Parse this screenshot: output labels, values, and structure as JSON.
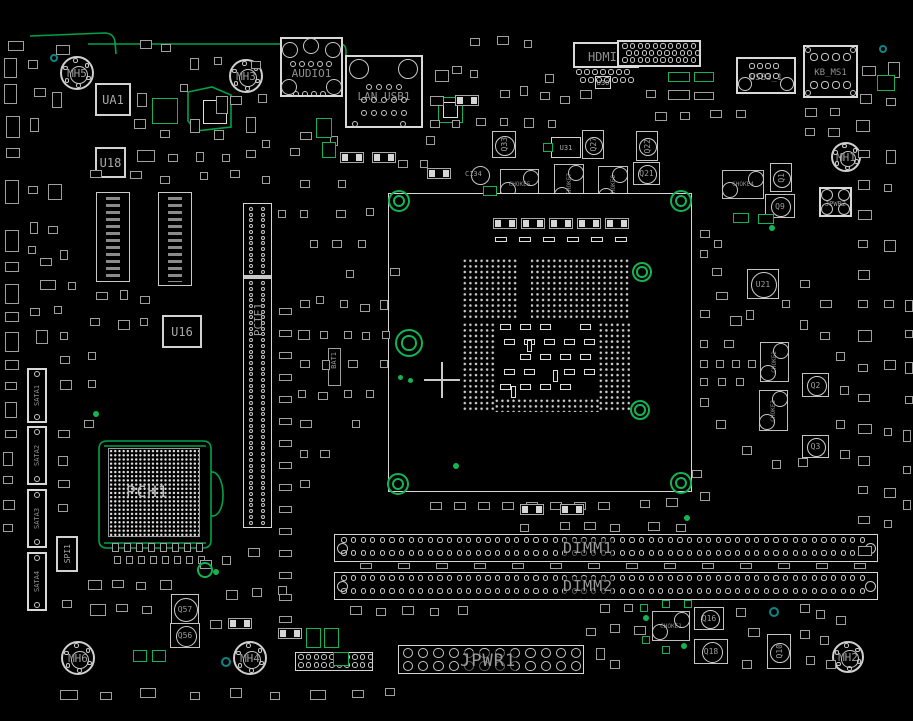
{
  "colors": {
    "background": "#000000",
    "outline": "#c8c8c8",
    "silkscreen": "#9a9a9a",
    "trace_green": "#00a248",
    "highlight_green": "#12b551",
    "teal": "#0d8585"
  },
  "board": {
    "width": 913,
    "height": 721
  },
  "components": [
    {
      "id": "ua1",
      "label": "UA1",
      "type": "ic",
      "x": 95,
      "y": 83,
      "w": 36,
      "h": 33
    },
    {
      "id": "u18",
      "label": "U18",
      "type": "ic",
      "x": 95,
      "y": 147,
      "w": 31,
      "h": 31
    },
    {
      "id": "u16",
      "label": "U16",
      "type": "ic",
      "x": 162,
      "y": 315,
      "w": 40,
      "h": 33
    },
    {
      "id": "u30",
      "label": "U30",
      "type": "ic_s",
      "x": 595,
      "y": 76,
      "w": 16,
      "h": 13
    },
    {
      "id": "u31",
      "label": "U31",
      "type": "ic_s",
      "x": 551,
      "y": 137,
      "w": 30,
      "h": 21
    },
    {
      "id": "spi1",
      "label": "SPI1",
      "type": "ic_v",
      "x": 56,
      "y": 536,
      "w": 22,
      "h": 36
    },
    {
      "id": "u21",
      "label": "U21",
      "type": "qcirc",
      "x": 747,
      "y": 269,
      "w": 32,
      "h": 30
    },
    {
      "id": "q33",
      "label": "Q33",
      "type": "qcirc_v",
      "x": 492,
      "y": 131,
      "w": 24,
      "h": 27
    },
    {
      "id": "q27",
      "label": "Q27",
      "type": "qcirc_v",
      "x": 582,
      "y": 130,
      "w": 22,
      "h": 29
    },
    {
      "id": "q22",
      "label": "Q22",
      "type": "qcirc_v",
      "x": 636,
      "y": 131,
      "w": 22,
      "h": 30
    },
    {
      "id": "q21",
      "label": "Q21",
      "type": "qcirc",
      "x": 633,
      "y": 162,
      "w": 27,
      "h": 23
    },
    {
      "id": "q1",
      "label": "Q1",
      "type": "qcirc_v",
      "x": 770,
      "y": 163,
      "w": 22,
      "h": 29
    },
    {
      "id": "q9",
      "label": "Q9",
      "type": "qcirc",
      "x": 765,
      "y": 194,
      "w": 30,
      "h": 24
    },
    {
      "id": "q2",
      "label": "Q2",
      "type": "qcirc",
      "x": 802,
      "y": 373,
      "w": 27,
      "h": 24
    },
    {
      "id": "q3",
      "label": "Q3",
      "type": "qcirc",
      "x": 802,
      "y": 435,
      "w": 27,
      "h": 23
    },
    {
      "id": "q10",
      "label": "Q10",
      "type": "qcirc_v",
      "x": 767,
      "y": 634,
      "w": 24,
      "h": 35
    },
    {
      "id": "q16",
      "label": "Q16",
      "type": "qcirc",
      "x": 694,
      "y": 607,
      "w": 30,
      "h": 23
    },
    {
      "id": "q18",
      "label": "Q18",
      "type": "qcirc",
      "x": 694,
      "y": 639,
      "w": 34,
      "h": 25
    },
    {
      "id": "q57",
      "label": "Q57",
      "type": "qcirc",
      "x": 171,
      "y": 594,
      "w": 28,
      "h": 30
    },
    {
      "id": "q56",
      "label": "Q56",
      "type": "qcirc",
      "x": 170,
      "y": 623,
      "w": 30,
      "h": 25
    },
    {
      "id": "c134",
      "label": "C134",
      "type": "cap",
      "x": 471,
      "y": 166,
      "w": 19,
      "h": 19
    },
    {
      "id": "choke5",
      "label": "CHOKE5",
      "type": "choke",
      "x": 500,
      "y": 169,
      "w": 39,
      "h": 30
    },
    {
      "id": "choke7",
      "label": "CHOKE7",
      "type": "choke_v",
      "x": 554,
      "y": 164,
      "w": 30,
      "h": 40
    },
    {
      "id": "choke8",
      "label": "CHOKE8",
      "type": "choke_v",
      "x": 598,
      "y": 166,
      "w": 30,
      "h": 39
    },
    {
      "id": "choke4",
      "label": "CHOKE4",
      "type": "choke",
      "x": 722,
      "y": 170,
      "w": 42,
      "h": 29
    },
    {
      "id": "choke2",
      "label": "CHOKE2",
      "type": "choke_v",
      "x": 760,
      "y": 342,
      "w": 29,
      "h": 40
    },
    {
      "id": "choke3",
      "label": "CHOKE3",
      "type": "choke_v",
      "x": 759,
      "y": 390,
      "w": 29,
      "h": 41
    },
    {
      "id": "choke1",
      "label": "CHOKE1",
      "type": "choke",
      "x": 652,
      "y": 611,
      "w": 38,
      "h": 30
    },
    {
      "id": "bat1",
      "label": "BAT1",
      "type": "label_v",
      "x": 328,
      "y": 348,
      "w": 13,
      "h": 38
    }
  ],
  "connectors": [
    {
      "id": "audio1",
      "label": "AUDIO1",
      "x": 280,
      "y": 37,
      "w": 63,
      "h": 60,
      "ly": 28,
      "fs": 11,
      "big": [
        [
          10,
          13,
          8
        ],
        [
          31,
          9,
          8
        ],
        [
          53,
          13,
          8
        ],
        [
          9,
          50,
          8
        ],
        [
          54,
          50,
          8
        ]
      ],
      "rows": [
        {
          "dx": 13,
          "dy": 27,
          "n": 5,
          "g": 9,
          "r": 3
        },
        {
          "dx": 16,
          "dy": 57,
          "n": 4,
          "g": 9,
          "r": 3
        }
      ]
    },
    {
      "id": "lan_usb1",
      "label": "LAN_USB1",
      "x": 345,
      "y": 55,
      "w": 78,
      "h": 73,
      "ly": 33,
      "fs": 11,
      "big": [
        [
          14,
          14,
          10
        ],
        [
          63,
          14,
          10
        ]
      ],
      "rows": [
        {
          "dx": 24,
          "dy": 32,
          "n": 4,
          "g": 10,
          "r": 3.4
        },
        {
          "dx": 19,
          "dy": 45,
          "n": 5,
          "g": 10,
          "r": 3.4
        },
        {
          "dx": 19,
          "dy": 58,
          "n": 5,
          "g": 10,
          "r": 3.4
        },
        {
          "dx": 10,
          "dy": 69,
          "n": 2,
          "g": 48,
          "r": 3.4
        }
      ]
    },
    {
      "id": "hdmi1",
      "label": "HDMI1",
      "x": 573,
      "y": 42,
      "w": 66,
      "h": 26,
      "ly": 6,
      "fs": 12,
      "big": [],
      "rows": [
        {
          "dx": 6,
          "dy": 30,
          "n": 7,
          "g": 8,
          "r": 2.6
        },
        {
          "dx": 10,
          "dy": 38,
          "n": 7,
          "g": 8,
          "r": 2.6
        }
      ]
    },
    {
      "id": "top_con",
      "label": "",
      "x": 617,
      "y": 40,
      "w": 84,
      "h": 27,
      "ly": 8,
      "fs": 8,
      "big": [],
      "rows": [
        {
          "dx": 8,
          "dy": 6,
          "n": 10,
          "g": 7.6,
          "r": 2.6
        },
        {
          "dx": 12,
          "dy": 13,
          "n": 10,
          "g": 7.6,
          "r": 2.6
        },
        {
          "dx": 8,
          "dy": 20,
          "n": 10,
          "g": 7.6,
          "r": 2.6
        }
      ]
    },
    {
      "id": "usb3_1",
      "label": "USB3_1",
      "x": 736,
      "y": 57,
      "w": 60,
      "h": 37,
      "ly": 14,
      "fs": 9,
      "big": [
        [
          9,
          27,
          7
        ],
        [
          51,
          27,
          7
        ]
      ],
      "rows": [
        {
          "dx": 16,
          "dy": 9,
          "n": 4,
          "g": 8,
          "r": 2.6
        },
        {
          "dx": 16,
          "dy": 19,
          "n": 4,
          "g": 8,
          "r": 2.6
        }
      ]
    },
    {
      "id": "kb_ms1",
      "label": "KB_MS1",
      "x": 803,
      "y": 45,
      "w": 55,
      "h": 53,
      "ly": 21,
      "fs": 9,
      "big": [],
      "corners": true,
      "rows": [
        {
          "dx": 11,
          "dy": 12,
          "n": 4,
          "g": 11,
          "r": 3.6
        },
        {
          "dx": 11,
          "dy": 40,
          "n": 4,
          "g": 11,
          "r": 3.6
        }
      ]
    },
    {
      "id": "jpwr2",
      "label": "JPWR2",
      "x": 819,
      "y": 187,
      "w": 33,
      "h": 30,
      "ly": 11,
      "fs": 7,
      "big": [
        [
          8,
          8,
          6
        ],
        [
          25,
          8,
          6
        ],
        [
          8,
          22,
          6
        ],
        [
          25,
          22,
          6
        ]
      ],
      "rows": []
    },
    {
      "id": "sata1",
      "label": "SATA1",
      "x": 27,
      "y": 368,
      "w": 20,
      "h": 55,
      "vert": true,
      "fs": 7
    },
    {
      "id": "sata2",
      "label": "SATA2",
      "x": 27,
      "y": 426,
      "w": 20,
      "h": 59,
      "vert": true,
      "fs": 7
    },
    {
      "id": "sata3",
      "label": "SATA3",
      "x": 27,
      "y": 489,
      "w": 20,
      "h": 59,
      "vert": true,
      "fs": 7
    },
    {
      "id": "sata4",
      "label": "SATA4",
      "x": 27,
      "y": 552,
      "w": 20,
      "h": 59,
      "vert": true,
      "fs": 7
    }
  ],
  "slots": {
    "pcie": {
      "label": "PCIE1",
      "x": 243,
      "y": 203,
      "w": 29,
      "h": 325
    },
    "dimm1": {
      "label": "DIMM1",
      "x": 334,
      "y": 534,
      "w": 544,
      "h": 28,
      "label_x": 563
    },
    "dimm2": {
      "label": "DIMM2",
      "x": 334,
      "y": 572,
      "w": 544,
      "h": 28,
      "label_x": 563
    },
    "jpwr1": {
      "label": "JPWR1",
      "x": 398,
      "y": 645,
      "w": 186,
      "h": 29
    },
    "fpanel": {
      "label": "",
      "x": 295,
      "y": 652,
      "w": 78,
      "h": 19
    }
  },
  "mounting_holes": [
    {
      "label": "MH5",
      "x": 77,
      "y": 73,
      "r": 17
    },
    {
      "label": "MH3",
      "x": 246,
      "y": 76,
      "r": 17
    },
    {
      "label": "MH1",
      "x": 846,
      "y": 157,
      "r": 15
    },
    {
      "label": "MH6",
      "x": 78,
      "y": 658,
      "r": 17
    },
    {
      "label": "MH4",
      "x": 250,
      "y": 658,
      "r": 17
    },
    {
      "label": "MH2",
      "x": 848,
      "y": 657,
      "r": 16
    }
  ],
  "socket": {
    "x": 388,
    "y": 193,
    "w": 304,
    "h": 299,
    "rings": [
      [
        399,
        201,
        11
      ],
      [
        681,
        201,
        11
      ],
      [
        398,
        484,
        11
      ],
      [
        681,
        483,
        11
      ],
      [
        642,
        272,
        10
      ],
      [
        640,
        410,
        10
      ]
    ],
    "big_ring": [
      409,
      343,
      14
    ],
    "cross": [
      442,
      380
    ]
  },
  "bga": {
    "label": "PCH1",
    "x": 108,
    "y": 448,
    "w": 92,
    "h": 89,
    "outline": {
      "x": 99,
      "y": 441,
      "w": 112,
      "h": 107
    }
  }
}
